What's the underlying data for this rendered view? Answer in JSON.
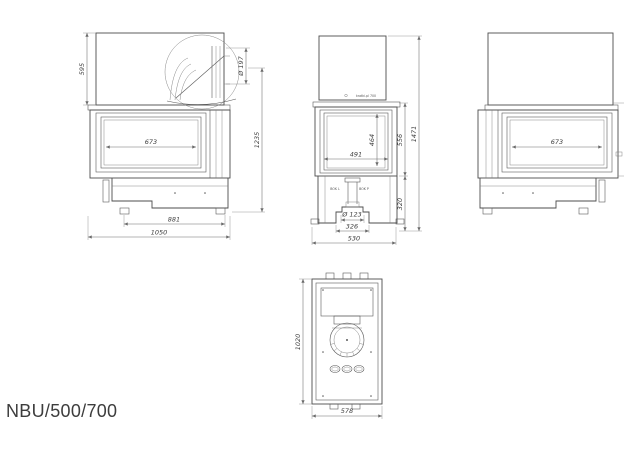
{
  "title": "NBU/500/700",
  "colors": {
    "line": "#4c4c4c",
    "dimension": "#6b6b6b",
    "text": "#3e3e3e",
    "background": "#ffffff"
  },
  "views": {
    "side_left": {
      "label": "left-side-view",
      "dims": {
        "hood_height": "595",
        "flue_diameter": "Ø 197",
        "glass_width": "673",
        "body_height": "1235",
        "base_width": "881",
        "total_depth": "1050"
      }
    },
    "front": {
      "label": "front-view",
      "logo": "kratki.pl 700",
      "duct_label_left": "BOK L",
      "duct_label_right": "BOK P",
      "dims": {
        "total_height": "1471",
        "firebox_height": "556",
        "glass_height": "464",
        "glass_width": "491",
        "base_height": "320",
        "air_inlet_diameter": "Ø 123",
        "inlet_frame_width": "326",
        "front_width": "530"
      }
    },
    "side_right": {
      "label": "right-side-view",
      "dims": {
        "glass_width": "673"
      }
    },
    "top": {
      "label": "top-view",
      "dims": {
        "depth": "1020",
        "width": "578"
      }
    }
  }
}
